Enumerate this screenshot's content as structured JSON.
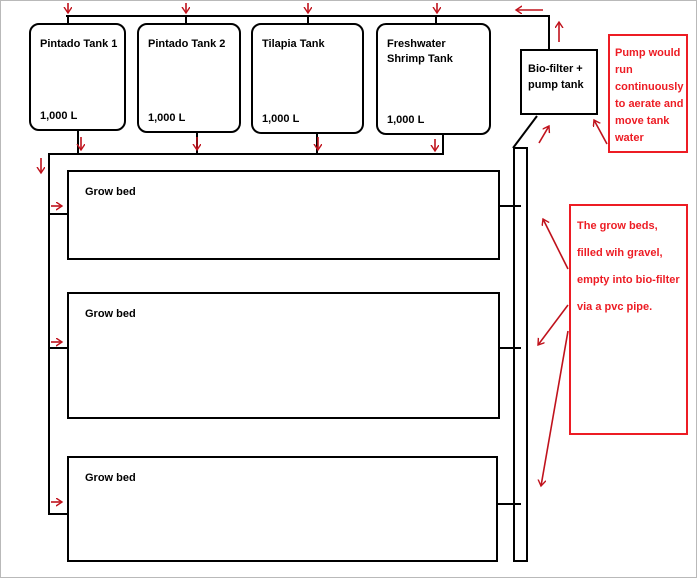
{
  "diagram": {
    "title": "Aquaponics system flow diagram",
    "tanks": [
      {
        "name": "Pintado Tank 1",
        "volume": "1,000 L"
      },
      {
        "name": "Pintado Tank 2",
        "volume": "1,000 L"
      },
      {
        "name": "Tilapia Tank",
        "volume": "1,000 L"
      },
      {
        "name": "Freshwater Shrimp Tank",
        "volume": "1,000 L"
      }
    ],
    "biofilter": {
      "label": "Bio-filter + pump tank"
    },
    "grow_beds": [
      {
        "label": "Grow bed"
      },
      {
        "label": "Grow bed"
      },
      {
        "label": "Grow bed"
      }
    ],
    "notes": [
      {
        "id": "pump-note",
        "text": "Pump would run continuously to aerate and move tank water"
      },
      {
        "id": "growbed-note",
        "text": "The grow beds, filled wih gravel, empty into bio-filter via a pvc pipe."
      }
    ],
    "colors": {
      "line": "#000000",
      "note_text": "#ed1c24",
      "arrow": "#c0121c",
      "background": "#ffffff"
    }
  }
}
